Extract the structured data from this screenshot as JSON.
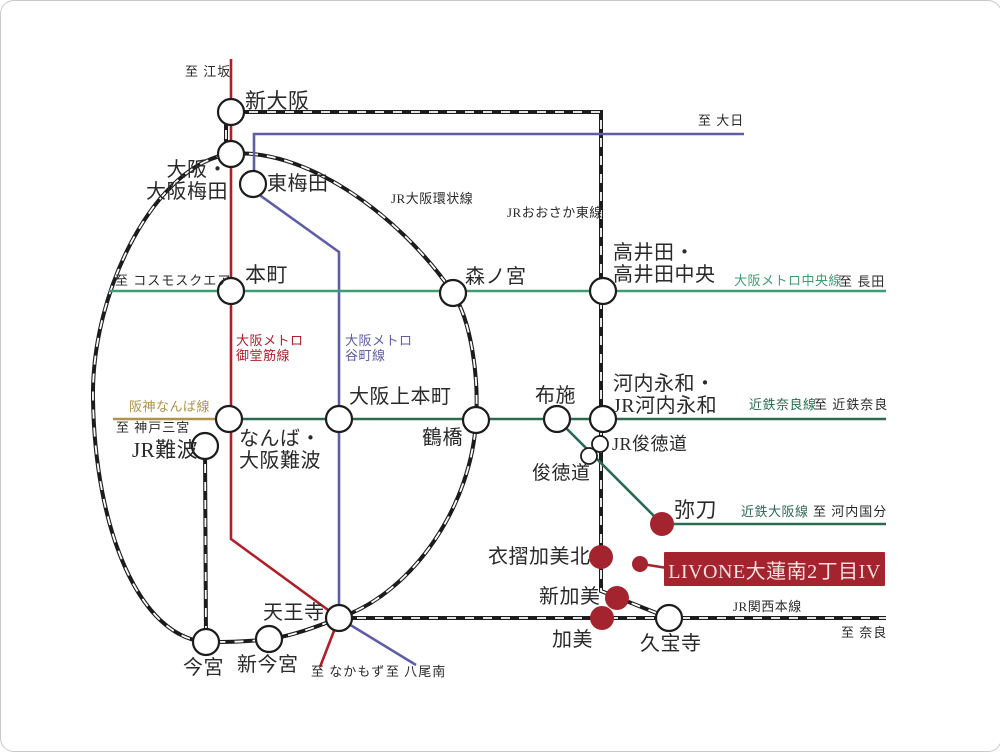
{
  "colors": {
    "ink": "#2a2a2a",
    "jr": "#1c1c1c",
    "midosuji": "#b01e28",
    "tanimachi": "#5d5da8",
    "chuo": "#3d9c74",
    "kintetsu": "#2a6b52",
    "hanshin": "#b3924a",
    "property": "#a3242e",
    "property_text": "#f3e2de",
    "station_fill": "#ffffff"
  },
  "property": {
    "name": "LIVONE大蓮南2丁目IV"
  },
  "line_labels": [
    {
      "text": "JR大阪環状線",
      "x": 390,
      "y": 191,
      "color": "ink",
      "size": 13
    },
    {
      "text": "JRおおさか東線",
      "x": 506,
      "y": 205,
      "color": "ink",
      "size": 13
    },
    {
      "text": "大阪メトロ中央線",
      "x": 733,
      "y": 273,
      "color": "chuo",
      "size": 13
    },
    {
      "text": "大阪メトロ\n御堂筋線",
      "x": 235,
      "y": 333,
      "color": "midosuji",
      "size": 13
    },
    {
      "text": "大阪メトロ\n谷町線",
      "x": 344,
      "y": 333,
      "color": "tanimachi",
      "size": 13
    },
    {
      "text": "阪神なんば線",
      "x": 128,
      "y": 399,
      "color": "hanshin",
      "size": 13
    },
    {
      "text": "近鉄奈良線",
      "x": 748,
      "y": 397,
      "color": "kintetsu",
      "size": 13
    },
    {
      "text": "近鉄大阪線",
      "x": 740,
      "y": 504,
      "color": "kintetsu",
      "size": 13
    },
    {
      "text": "JR関西本線",
      "x": 732,
      "y": 599,
      "color": "ink",
      "size": 13
    }
  ],
  "terminals": [
    {
      "text": "至 江坂",
      "x": 184,
      "y": 64
    },
    {
      "text": "至 大日",
      "x": 697,
      "y": 113
    },
    {
      "text": "至 コスモスクエア",
      "x": 114,
      "y": 273
    },
    {
      "text": "至 長田",
      "x": 838,
      "y": 274
    },
    {
      "text": "至 神戸三宮",
      "x": 115,
      "y": 420
    },
    {
      "text": "至 近鉄奈良",
      "x": 813,
      "y": 397
    },
    {
      "text": "至 河内国分",
      "x": 812,
      "y": 504
    },
    {
      "text": "至 奈良",
      "x": 840,
      "y": 625
    },
    {
      "text": "至 なかもず",
      "x": 310,
      "y": 664
    },
    {
      "text": "至 八尾南",
      "x": 385,
      "y": 664
    }
  ],
  "stations": [
    {
      "name": "新大阪",
      "x": 230,
      "y": 111,
      "type": "normal",
      "label": {
        "text": "新大阪",
        "x": 244,
        "y": 89,
        "size": 21
      }
    },
    {
      "name": "大阪・大阪梅田",
      "x": 230,
      "y": 153,
      "type": "normal",
      "label": {
        "text": "大阪・\n大阪梅田",
        "x": 227,
        "y": 158,
        "size": 20,
        "align": "right"
      }
    },
    {
      "name": "東梅田",
      "x": 252,
      "y": 183,
      "type": "normal",
      "label": {
        "text": "東梅田",
        "x": 266,
        "y": 172,
        "size": 20
      }
    },
    {
      "name": "本町",
      "x": 230,
      "y": 290,
      "type": "normal",
      "label": {
        "text": "本町",
        "x": 244,
        "y": 263,
        "size": 21
      }
    },
    {
      "name": "森ノ宮",
      "x": 452,
      "y": 292,
      "type": "normal",
      "label": {
        "text": "森ノ宮",
        "x": 464,
        "y": 265,
        "size": 20
      }
    },
    {
      "name": "高井田・高井田中央",
      "x": 602,
      "y": 290,
      "type": "normal",
      "label": {
        "text": "高井田・\n高井田中央",
        "x": 612,
        "y": 241,
        "size": 20
      }
    },
    {
      "name": "なんば・大阪難波",
      "x": 228,
      "y": 418,
      "type": "normal",
      "label": {
        "text": "なんば・\n大阪難波",
        "x": 238,
        "y": 427,
        "size": 20
      }
    },
    {
      "name": "大阪上本町",
      "x": 338,
      "y": 418,
      "type": "normal",
      "label": {
        "text": "大阪上本町",
        "x": 348,
        "y": 385,
        "size": 20
      }
    },
    {
      "name": "鶴橋",
      "x": 475,
      "y": 419,
      "type": "normal",
      "label": {
        "text": "鶴橋",
        "x": 421,
        "y": 426,
        "size": 20
      }
    },
    {
      "name": "布施",
      "x": 556,
      "y": 418,
      "type": "normal",
      "label": {
        "text": "布施",
        "x": 534,
        "y": 384,
        "size": 20
      }
    },
    {
      "name": "河内永和・JR河内永和",
      "x": 602,
      "y": 418,
      "type": "normal",
      "label": {
        "text": "河内永和・\nJR河内永和",
        "x": 612,
        "y": 372,
        "size": 20
      }
    },
    {
      "name": "JR難波",
      "x": 204,
      "y": 445,
      "type": "normal",
      "label": {
        "text": "JR難波",
        "x": 131,
        "y": 438,
        "size": 21
      }
    },
    {
      "name": "JR俊徳道",
      "x": 599,
      "y": 443,
      "type": "small",
      "label": {
        "text": "JR俊徳道",
        "x": 611,
        "y": 433,
        "size": 18
      }
    },
    {
      "name": "俊徳道",
      "x": 588,
      "y": 455,
      "type": "small",
      "label": {
        "text": "俊徳道",
        "x": 531,
        "y": 462,
        "size": 19
      }
    },
    {
      "name": "弥刀",
      "x": 661,
      "y": 523,
      "type": "highlight",
      "label": {
        "text": "弥刀",
        "x": 673,
        "y": 498,
        "size": 21
      }
    },
    {
      "name": "衣摺加美北",
      "x": 600,
      "y": 556,
      "type": "highlight",
      "label": {
        "text": "衣摺加美北",
        "x": 487,
        "y": 545,
        "size": 20
      }
    },
    {
      "name": "新加美",
      "x": 616,
      "y": 597,
      "type": "highlight",
      "label": {
        "text": "新加美",
        "x": 538,
        "y": 585,
        "size": 20
      }
    },
    {
      "name": "加美",
      "x": 601,
      "y": 617,
      "type": "highlight",
      "label": {
        "text": "加美",
        "x": 551,
        "y": 628,
        "size": 20
      }
    },
    {
      "name": "天王寺",
      "x": 338,
      "y": 617,
      "type": "normal",
      "label": {
        "text": "天王寺",
        "x": 262,
        "y": 601,
        "size": 20
      }
    },
    {
      "name": "新今宮",
      "x": 268,
      "y": 638,
      "type": "normal",
      "label": {
        "text": "新今宮",
        "x": 236,
        "y": 653,
        "size": 20
      }
    },
    {
      "name": "今宮",
      "x": 205,
      "y": 641,
      "type": "normal",
      "label": {
        "text": "今宮",
        "x": 182,
        "y": 656,
        "size": 20
      }
    },
    {
      "name": "久宝寺",
      "x": 668,
      "y": 617,
      "type": "normal",
      "label": {
        "text": "久宝寺",
        "x": 639,
        "y": 632,
        "size": 20
      }
    }
  ]
}
